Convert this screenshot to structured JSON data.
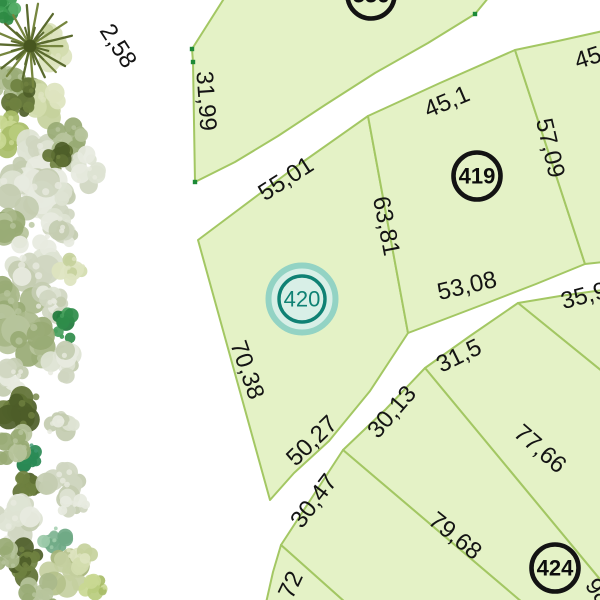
{
  "map": {
    "background_color": "#ffffff",
    "parcel_fill": "#e4f2c6",
    "parcel_stroke": "#a3c763",
    "label_color": "#141414",
    "vertex_dot_color": "#1d8a37",
    "selected_marker": {
      "number": "420",
      "ring_color": "#0f8174",
      "halo_color": "#93d3c4",
      "halo_fill": "#d8efe7",
      "text_color": "#0f8174"
    },
    "parcels": [
      {
        "id": "block-336",
        "points": "192,49 225,-3 489,-3 475,14 428,43 375,73 325,105 278,136 235,162 195,182 193,62"
      },
      {
        "id": "plot-420",
        "points": "198,240 290,171 368,116 408,333 370,391 329,441 294,473 270,500"
      },
      {
        "id": "plot-419",
        "points": "368,116 440,83 515,50 585,264 536,284 487,303 445,319 408,333"
      },
      {
        "id": "plot-45",
        "points": "515,50 558,41 603,31 603,262 585,264"
      },
      {
        "id": "plot-35-9",
        "points": "518,303 560,296 603,290 603,372"
      },
      {
        "id": "plot-31-5",
        "points": "425,368 470,336 518,303 603,372 603,583"
      },
      {
        "id": "plot-424",
        "points": "343,450 386,409 425,368 603,583 603,603 523,603"
      },
      {
        "id": "plot-30-47",
        "points": "281,545 311,499 343,450 523,603 346,603"
      },
      {
        "id": "plot-72",
        "points": "281,545 346,603 266,603 273,572"
      }
    ],
    "dimension_labels": [
      {
        "text": "2,58",
        "x": 118,
        "y": 46,
        "rot": 57
      },
      {
        "text": "31,99",
        "x": 206,
        "y": 101,
        "rot": 86
      },
      {
        "text": "55,01",
        "x": 286,
        "y": 179,
        "rot": -33
      },
      {
        "text": "63,81",
        "x": 386,
        "y": 226,
        "rot": 79
      },
      {
        "text": "45,1",
        "x": 447,
        "y": 102,
        "rot": -23
      },
      {
        "text": "57,09",
        "x": 550,
        "y": 148,
        "rot": 77
      },
      {
        "text": "45",
        "x": 588,
        "y": 58,
        "rot": -18
      },
      {
        "text": "53,08",
        "x": 467,
        "y": 286,
        "rot": -13
      },
      {
        "text": "35,9",
        "x": 584,
        "y": 296,
        "rot": -15
      },
      {
        "text": "31,5",
        "x": 459,
        "y": 356,
        "rot": -26
      },
      {
        "text": "30,13",
        "x": 392,
        "y": 412,
        "rot": -49
      },
      {
        "text": "30,47",
        "x": 314,
        "y": 501,
        "rot": -53
      },
      {
        "text": "77,66",
        "x": 540,
        "y": 449,
        "rot": 41
      },
      {
        "text": "79,68",
        "x": 455,
        "y": 536,
        "rot": 39
      },
      {
        "text": "70,38",
        "x": 247,
        "y": 370,
        "rot": 71
      },
      {
        "text": "50,27",
        "x": 312,
        "y": 441,
        "rot": -44
      },
      {
        "text": "72",
        "x": 291,
        "y": 585,
        "rot": -65
      },
      {
        "text": "98",
        "x": 598,
        "y": 592,
        "rot": 55
      }
    ],
    "plot_markers": [
      {
        "number": "336",
        "x": 371,
        "y": -5,
        "selected": false
      },
      {
        "number": "419",
        "x": 477,
        "y": 176,
        "selected": false
      },
      {
        "number": "424",
        "x": 555,
        "y": 568,
        "selected": false
      },
      {
        "number": "420",
        "x": 302,
        "y": 299,
        "selected": true
      }
    ],
    "vertex_dots": [
      [
        192,
        49
      ],
      [
        193,
        62
      ],
      [
        195,
        182
      ],
      [
        475,
        14
      ]
    ],
    "vegetation": {
      "palettes": {
        "pale": [
          "#dde3d2",
          "#cfd6c0",
          "#c3ccb0",
          "#e7eadf"
        ],
        "sage": [
          "#a9b98a",
          "#98aa74",
          "#b7c49c"
        ],
        "olive": [
          "#5f7134",
          "#4d5d28",
          "#6f8140"
        ],
        "bright": [
          "#3c9c51",
          "#2e8a43",
          "#55ad66"
        ],
        "emerald": [
          "#2f8c4a",
          "#1f7a3c",
          "#46a05c"
        ],
        "emeraldTeal": [
          "#2a8a55",
          "#1e7847",
          "#3d9970"
        ],
        "tealBush": [
          "#86b998",
          "#6fa985",
          "#9ccaa9"
        ],
        "yellowGreen": [
          "#b9cc7d",
          "#a8bd68",
          "#c9d893"
        ],
        "paleYellow": [
          "#d3dcae",
          "#c6d19c",
          "#dde4bf"
        ],
        "sageYellow": [
          "#b4c18b",
          "#a5b378",
          "#c4cf9f"
        ]
      },
      "palm": {
        "x": 30,
        "y": 46,
        "r": 42,
        "frond_color": "#5a6a2e",
        "frond_color2": "#76863f",
        "core_color": "#47561f"
      },
      "clusters": [
        {
          "x": 12,
          "y": 8,
          "r": 20,
          "p": "bright"
        },
        {
          "x": 52,
          "y": 46,
          "r": 22,
          "p": "paleYellow"
        },
        {
          "x": 15,
          "y": 86,
          "r": 26,
          "p": "sage"
        },
        {
          "x": 47,
          "y": 100,
          "r": 24,
          "p": "paleYellow"
        },
        {
          "x": 20,
          "y": 98,
          "r": 20,
          "p": "olive"
        },
        {
          "x": 8,
          "y": 135,
          "r": 22,
          "p": "yellowGreen"
        },
        {
          "x": 40,
          "y": 150,
          "r": 26,
          "p": "pale"
        },
        {
          "x": 68,
          "y": 138,
          "r": 20,
          "p": "sage"
        },
        {
          "x": 85,
          "y": 170,
          "r": 20,
          "p": "pale"
        },
        {
          "x": 20,
          "y": 180,
          "r": 28,
          "p": "pale"
        },
        {
          "x": 57,
          "y": 158,
          "r": 18,
          "p": "olive"
        },
        {
          "x": 45,
          "y": 198,
          "r": 30,
          "p": "pale"
        },
        {
          "x": 12,
          "y": 225,
          "r": 25,
          "p": "sage"
        },
        {
          "x": 62,
          "y": 228,
          "r": 22,
          "p": "pale"
        },
        {
          "x": 30,
          "y": 262,
          "r": 30,
          "p": "pale"
        },
        {
          "x": 70,
          "y": 268,
          "r": 18,
          "p": "paleYellow"
        },
        {
          "x": 15,
          "y": 300,
          "r": 28,
          "p": "sage"
        },
        {
          "x": 50,
          "y": 302,
          "r": 22,
          "p": "pale"
        },
        {
          "x": 65,
          "y": 325,
          "r": 18,
          "p": "emerald"
        },
        {
          "x": 25,
          "y": 342,
          "r": 30,
          "p": "sage"
        },
        {
          "x": 62,
          "y": 362,
          "r": 22,
          "p": "pale"
        },
        {
          "x": 8,
          "y": 378,
          "r": 20,
          "p": "pale"
        },
        {
          "x": 25,
          "y": 410,
          "r": 28,
          "p": "olive"
        },
        {
          "x": 60,
          "y": 420,
          "r": 20,
          "p": "pale"
        },
        {
          "x": 30,
          "y": 455,
          "r": 16,
          "p": "emeraldTeal"
        },
        {
          "x": 10,
          "y": 445,
          "r": 22,
          "p": "sage"
        },
        {
          "x": 28,
          "y": 482,
          "r": 18,
          "p": "olive"
        },
        {
          "x": 62,
          "y": 482,
          "r": 24,
          "p": "pale"
        },
        {
          "x": 15,
          "y": 520,
          "r": 26,
          "p": "pale"
        },
        {
          "x": 75,
          "y": 505,
          "r": 18,
          "p": "pale"
        },
        {
          "x": 55,
          "y": 540,
          "r": 16,
          "p": "tealBush"
        },
        {
          "x": 25,
          "y": 565,
          "r": 24,
          "p": "olive"
        },
        {
          "x": 68,
          "y": 572,
          "r": 26,
          "p": "sageYellow"
        },
        {
          "x": 95,
          "y": 588,
          "r": 16,
          "p": "yellowGreen"
        },
        {
          "x": 40,
          "y": 595,
          "r": 20,
          "p": "sage"
        },
        {
          "x": 8,
          "y": 560,
          "r": 18,
          "p": "sage"
        },
        {
          "x": 80,
          "y": 555,
          "r": 18,
          "p": "paleYellow"
        }
      ]
    }
  }
}
